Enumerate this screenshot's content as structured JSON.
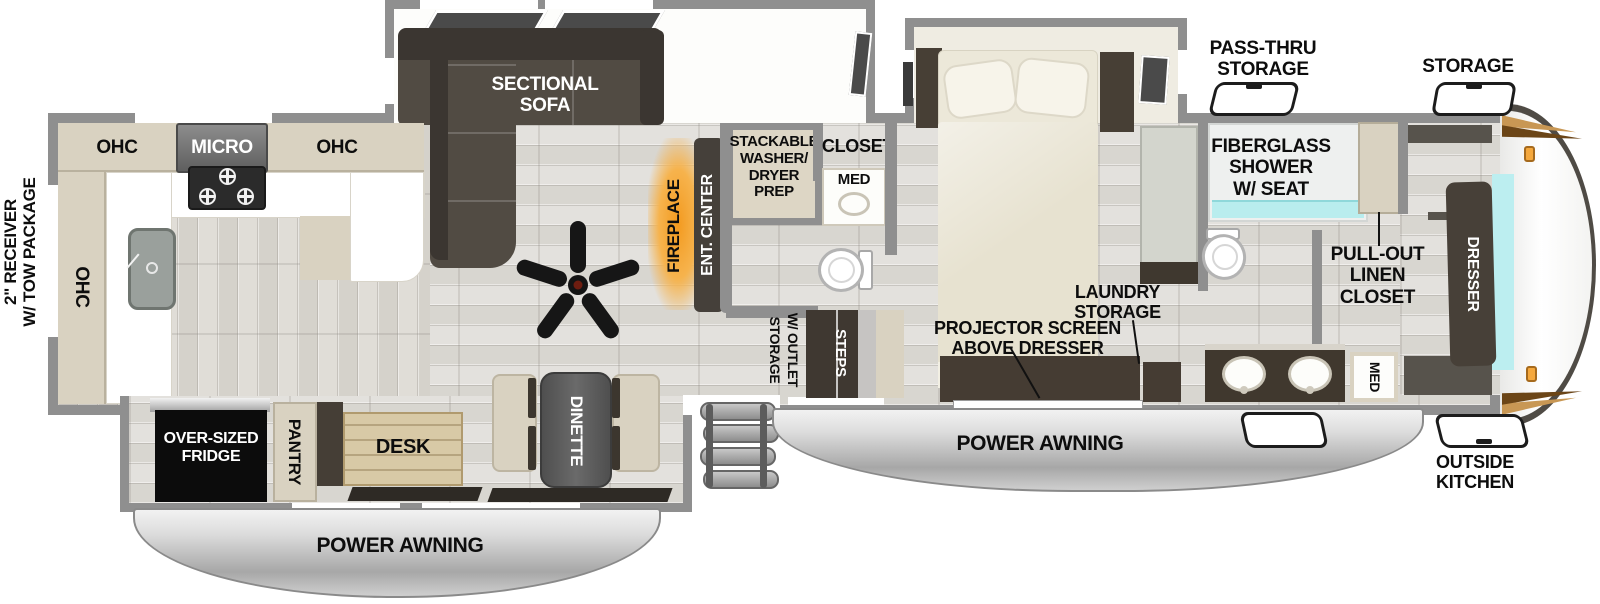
{
  "diagram_type": "RV fifth-wheel floor plan (top view)",
  "labels": {
    "receiver": "2\" RECEIVER\nW/ TOW PACKAGE",
    "ohc_kitchen_left": "OHC",
    "micro": "MICRO",
    "ohc_kitchen_right": "OHC",
    "ohc_kitchen_wall": "OHC",
    "sectional_sofa": "SECTIONAL\nSOFA",
    "fireplace": "FIREPLACE",
    "ent_center": "ENT. CENTER",
    "stackable_wd": "STACKABLE\nWASHER/\nDRYER\nPREP",
    "closet": "CLOSET",
    "med_half_bath": "MED",
    "storage_outlet_line1": "STORAGE",
    "storage_outlet_line2": "W/ OUTLET",
    "steps": "STEPS",
    "pass_thru_storage": "PASS-THRU\nSTORAGE",
    "storage_front": "STORAGE",
    "fiberglass_shower": "FIBERGLASS\nSHOWER\nW/ SEAT",
    "laundry_storage": "LAUNDRY\nSTORAGE",
    "projector_screen": "PROJECTOR SCREEN\nABOVE DRESSER",
    "pull_out_linen": "PULL-OUT\nLINEN\nCLOSET",
    "dresser": "DRESSER",
    "med_front_bath": "MED",
    "outside_kitchen": "OUTSIDE\nKITCHEN",
    "power_awning_left": "POWER AWNING",
    "power_awning_right": "POWER AWNING",
    "oversized_fridge": "OVER-SIZED\nFRIDGE",
    "pantry": "PANTRY",
    "desk": "DESK",
    "dinette": "DINETTE"
  },
  "colors": {
    "wall_gray": "#8f8f8f",
    "furniture_dark": "#453e36",
    "cabinet_tan": "#d9d2c1",
    "accent_teal": "#bceef0",
    "fireplace_orange": "#f39a1f",
    "awning_silver": "#c9c9c9",
    "floor_light": "#e0ded9",
    "fridge_black": "#0c0c0c",
    "cap_accent_orange": "#c89754"
  }
}
